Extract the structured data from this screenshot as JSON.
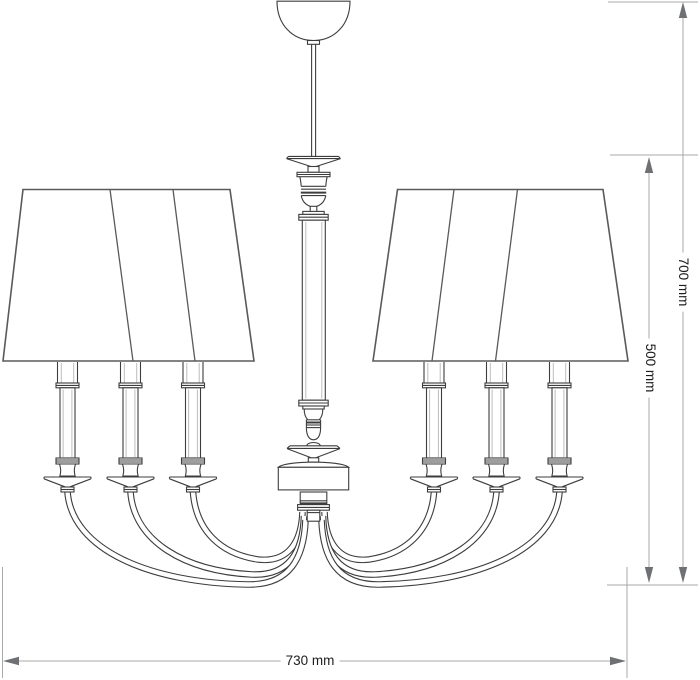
{
  "dimensions": {
    "total_height": {
      "label": "700 mm",
      "value": 700,
      "unit": "mm"
    },
    "body_height": {
      "label": "500 mm",
      "value": 500,
      "unit": "mm"
    },
    "width": {
      "label": "730 mm",
      "value": 730,
      "unit": "mm"
    }
  },
  "colors": {
    "background": "#ffffff",
    "drawing_stroke": "#3d3d3d",
    "shade_stroke": "#5a5a5a",
    "light_detail": "#bcbcbc",
    "dimension_line": "#a9a9a9",
    "arrow_fill": "#6e7073",
    "label_text": "#1d1d1d"
  }
}
